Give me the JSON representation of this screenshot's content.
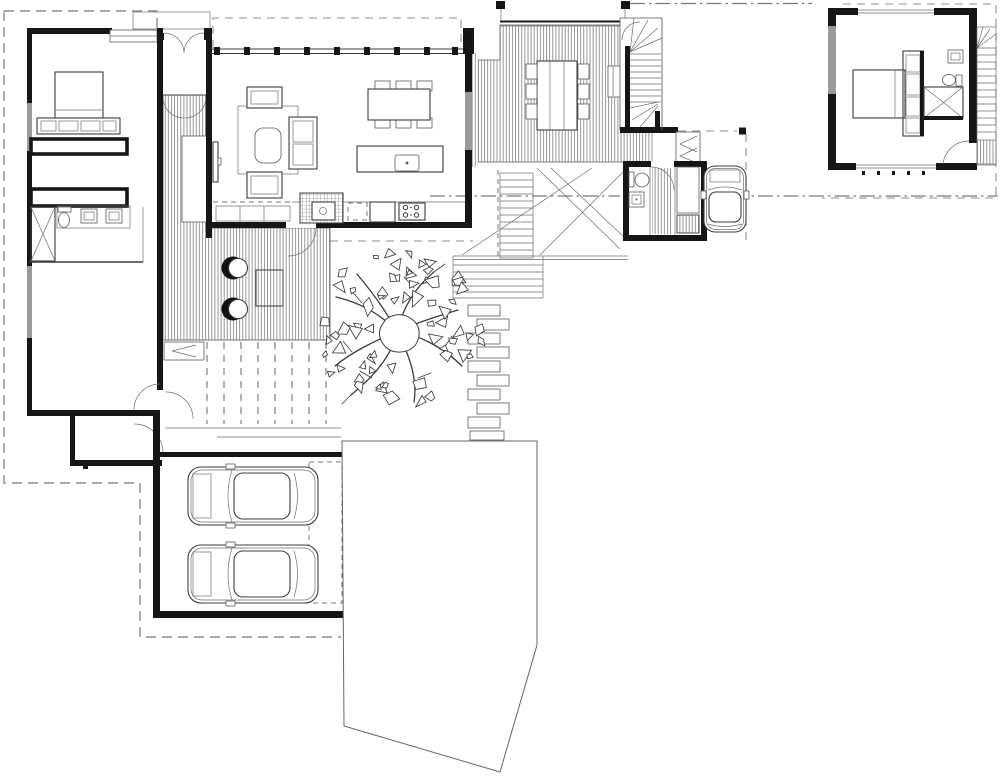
{
  "document": {
    "title": "Residential architectural floor plan"
  },
  "colors": {
    "background": "#ffffff",
    "wall": "#161616",
    "line": "#3c3c3c",
    "hatch": "#7e7e7e",
    "dashed": "#8c8c8c",
    "window": "#9a9a9a"
  },
  "labels": {
    "plan": "ground floor site plan with detached upper floor plan",
    "site_boundary": "property boundary",
    "master_wing": "bedroom wing with robe and ensuite",
    "entry": "entry double doors",
    "living_wing": "open plan living dining kitchen",
    "entry_deck": "timber deck",
    "courtyard": "courtyard deck with lounge chairs",
    "pergola": "pergola battens",
    "garage": "double garage",
    "driveway": "driveway",
    "path": "stepping stone path",
    "outdoor_stairs": "garden steps",
    "ramp": "driveway ramp",
    "tree": "existing tree",
    "upper_deck": "outdoor dining deck",
    "stair": "main staircase",
    "hall": "hallway",
    "powder_room": "powder room",
    "storage": "store",
    "carport": "visitor car space",
    "upper_unit": "upper floor bedroom with ensuite and stair"
  },
  "site": {
    "tree": {
      "cx": 397,
      "cy": 332,
      "inner": 26,
      "rx": 86,
      "ry": 80,
      "leaf_count": 66
    }
  }
}
